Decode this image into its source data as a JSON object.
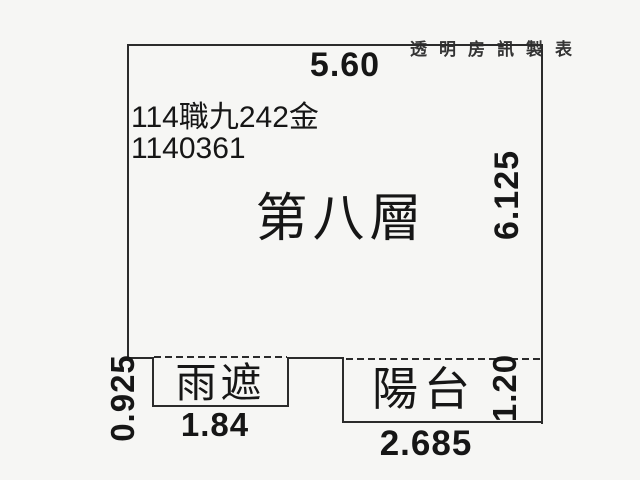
{
  "watermark": "透明房訊製表",
  "plan": {
    "case_number": "114職九242金",
    "serial_number": "1140361",
    "floor_label": "第八層",
    "canopy_label": "雨遮",
    "balcony_label": "陽台"
  },
  "dimensions": {
    "top_width": "5.60",
    "right_height": "6.125",
    "canopy_depth": "0.925",
    "canopy_width": "1.84",
    "balcony_depth": "1.20",
    "balcony_width": "2.685"
  },
  "colors": {
    "line": "#2b2b2b",
    "text": "#161616",
    "background": "#f6f6f4"
  }
}
